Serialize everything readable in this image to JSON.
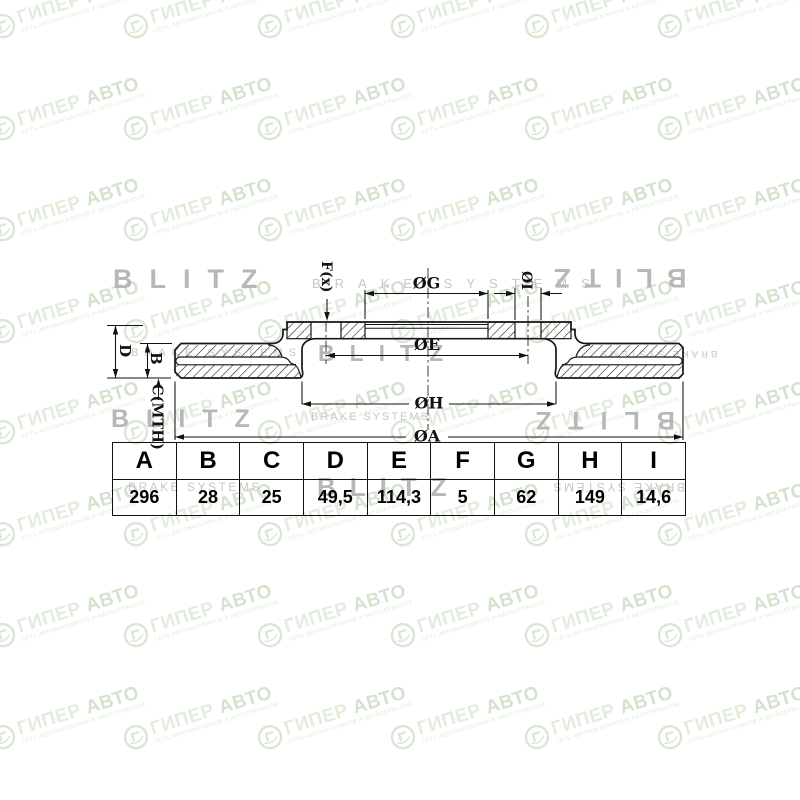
{
  "dimension_table": {
    "headers": [
      "A",
      "B",
      "C",
      "D",
      "E",
      "F",
      "G",
      "H",
      "I"
    ],
    "values": [
      "296",
      "28",
      "25",
      "49,5",
      "114,3",
      "5",
      "62",
      "149",
      "14,6"
    ]
  },
  "drawing": {
    "labels": {
      "dia_g": "ØG",
      "dia_i": "ØI",
      "f_x": "F(x)",
      "dia_e": "ØE",
      "dia_h": "ØH",
      "dia_a": "ØA",
      "d": "D",
      "b": "B",
      "c_mth": "C(MTH)"
    },
    "line_color": "#161616"
  },
  "watermarks": {
    "brand": {
      "name_part1": "ГИПЕР",
      "name_part2": "АВТО",
      "tagline": "СЕТЬ АВТОМАГАЗИНОВ И АВТОСЕРВИСОВ",
      "color_light": "#e2edde",
      "color_dark": "#d3e3ce",
      "grid": {
        "rows": 8,
        "cols": 6
      }
    },
    "blitz": {
      "brand": "BLITZ",
      "sub": "BRAKE SYSTEMS",
      "brand_color": "#b7b7b7",
      "sub_color": "#c7c7c7"
    }
  }
}
